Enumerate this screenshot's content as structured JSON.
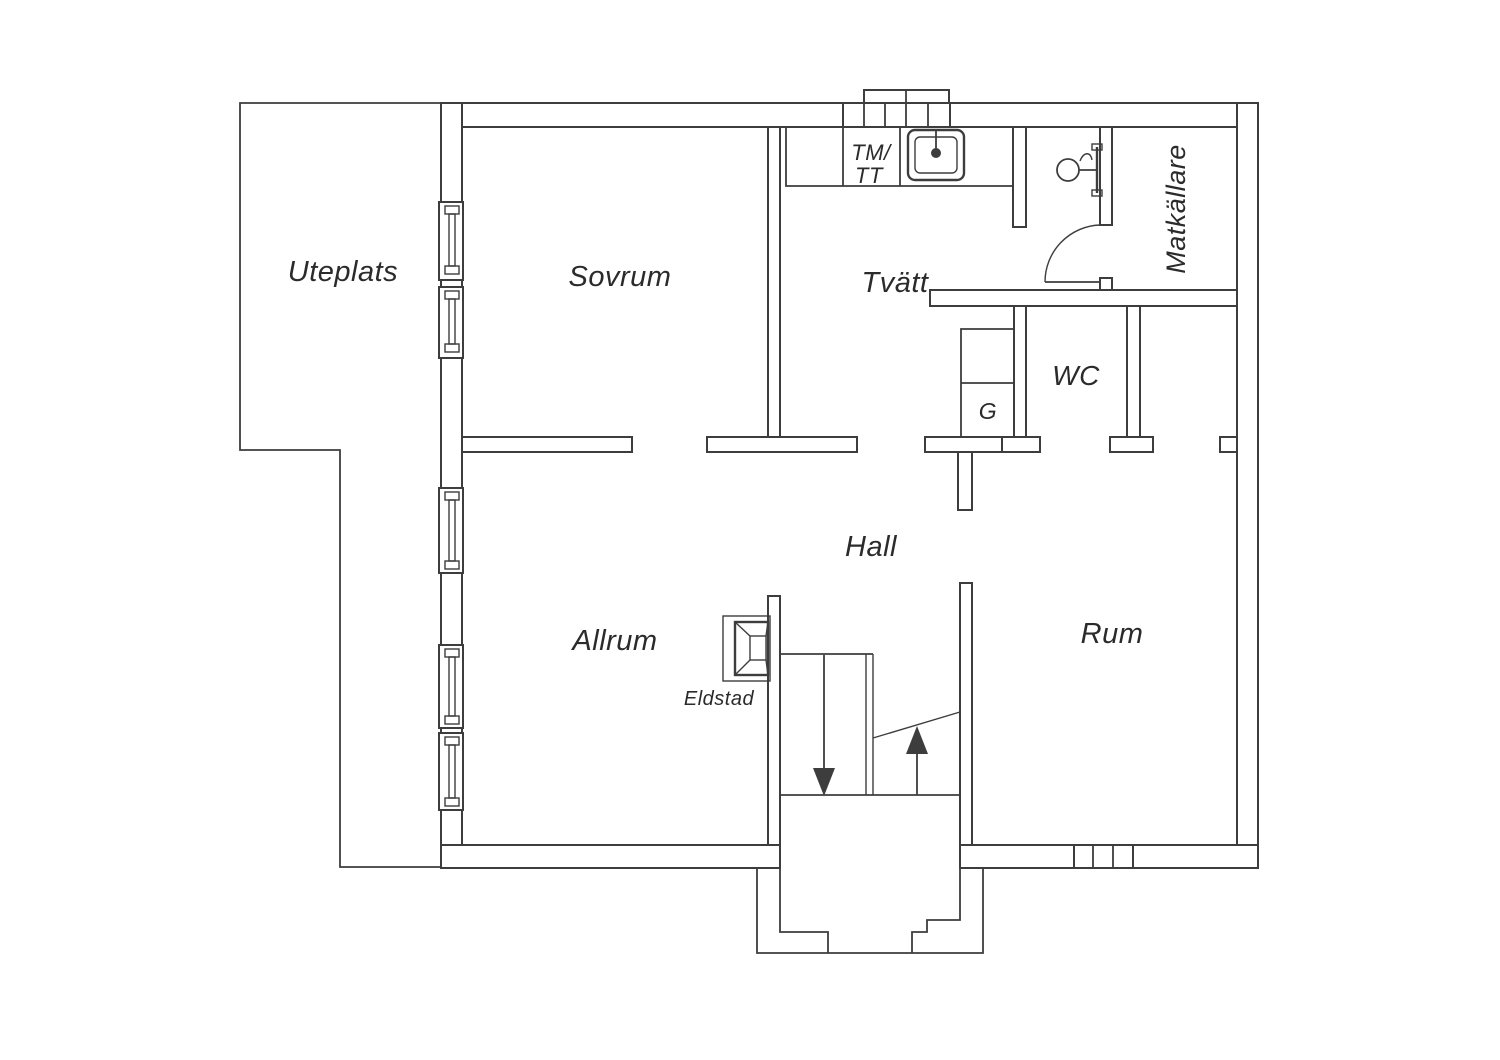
{
  "floorplan": {
    "type": "floor_plan",
    "language": "sv",
    "colors": {
      "line": "#3d3d3d",
      "text": "#2b2b2b",
      "background": "#ffffff"
    },
    "labels": {
      "uteplats": "Uteplats",
      "sovrum": "Sovrum",
      "tvatt": "Tvätt",
      "matkallare": "Matkällare",
      "wc": "WC",
      "garderob": "G",
      "hall": "Hall",
      "allrum": "Allrum",
      "rum": "Rum",
      "eldstad": "Eldstad",
      "tmtt_line1": "TM/",
      "tmtt_line2": "TT"
    },
    "rooms": [
      {
        "id": "uteplats",
        "label": "Uteplats"
      },
      {
        "id": "sovrum",
        "label": "Sovrum"
      },
      {
        "id": "tvatt",
        "label": "Tvätt"
      },
      {
        "id": "matkallare",
        "label": "Matkällare"
      },
      {
        "id": "wc",
        "label": "WC"
      },
      {
        "id": "garderob",
        "label": "G"
      },
      {
        "id": "hall",
        "label": "Hall"
      },
      {
        "id": "allrum",
        "label": "Allrum"
      },
      {
        "id": "rum",
        "label": "Rum"
      },
      {
        "id": "eldstad",
        "label": "Eldstad"
      },
      {
        "id": "tvattmaskin_torktumlare",
        "label": "TM/TT"
      }
    ]
  }
}
